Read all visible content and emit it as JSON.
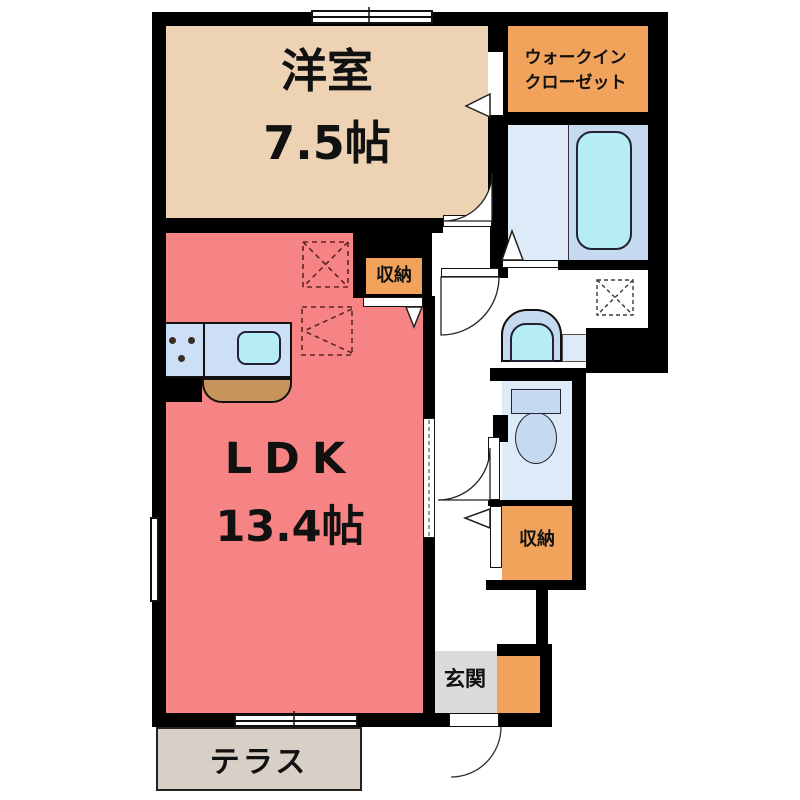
{
  "colors": {
    "wall": "#000000",
    "western": "#EDD3B4",
    "ldk": "#F68484",
    "orange": "#F1A35C",
    "bathfloor": "#DDEBF8",
    "bathzone": "#C5D9F0",
    "cyan": "#B6EDF4",
    "kcounter": "#CCDFF6",
    "brown": "#C9945C",
    "genkan": "#DBDBDB",
    "terrace": "#D8D0C6"
  },
  "rooms": {
    "western": {
      "name": "洋室",
      "size": "7.5帖"
    },
    "ldk": {
      "name": "LDK",
      "size": "13.4帖"
    },
    "walk_in_closet": {
      "line1": "ウォークイン",
      "line2": "クローゼット"
    },
    "storage_upper": {
      "label": "収納"
    },
    "storage_lower": {
      "label": "収納"
    },
    "genkan": {
      "label": "玄関"
    },
    "terrace": {
      "label": "テラス"
    }
  }
}
